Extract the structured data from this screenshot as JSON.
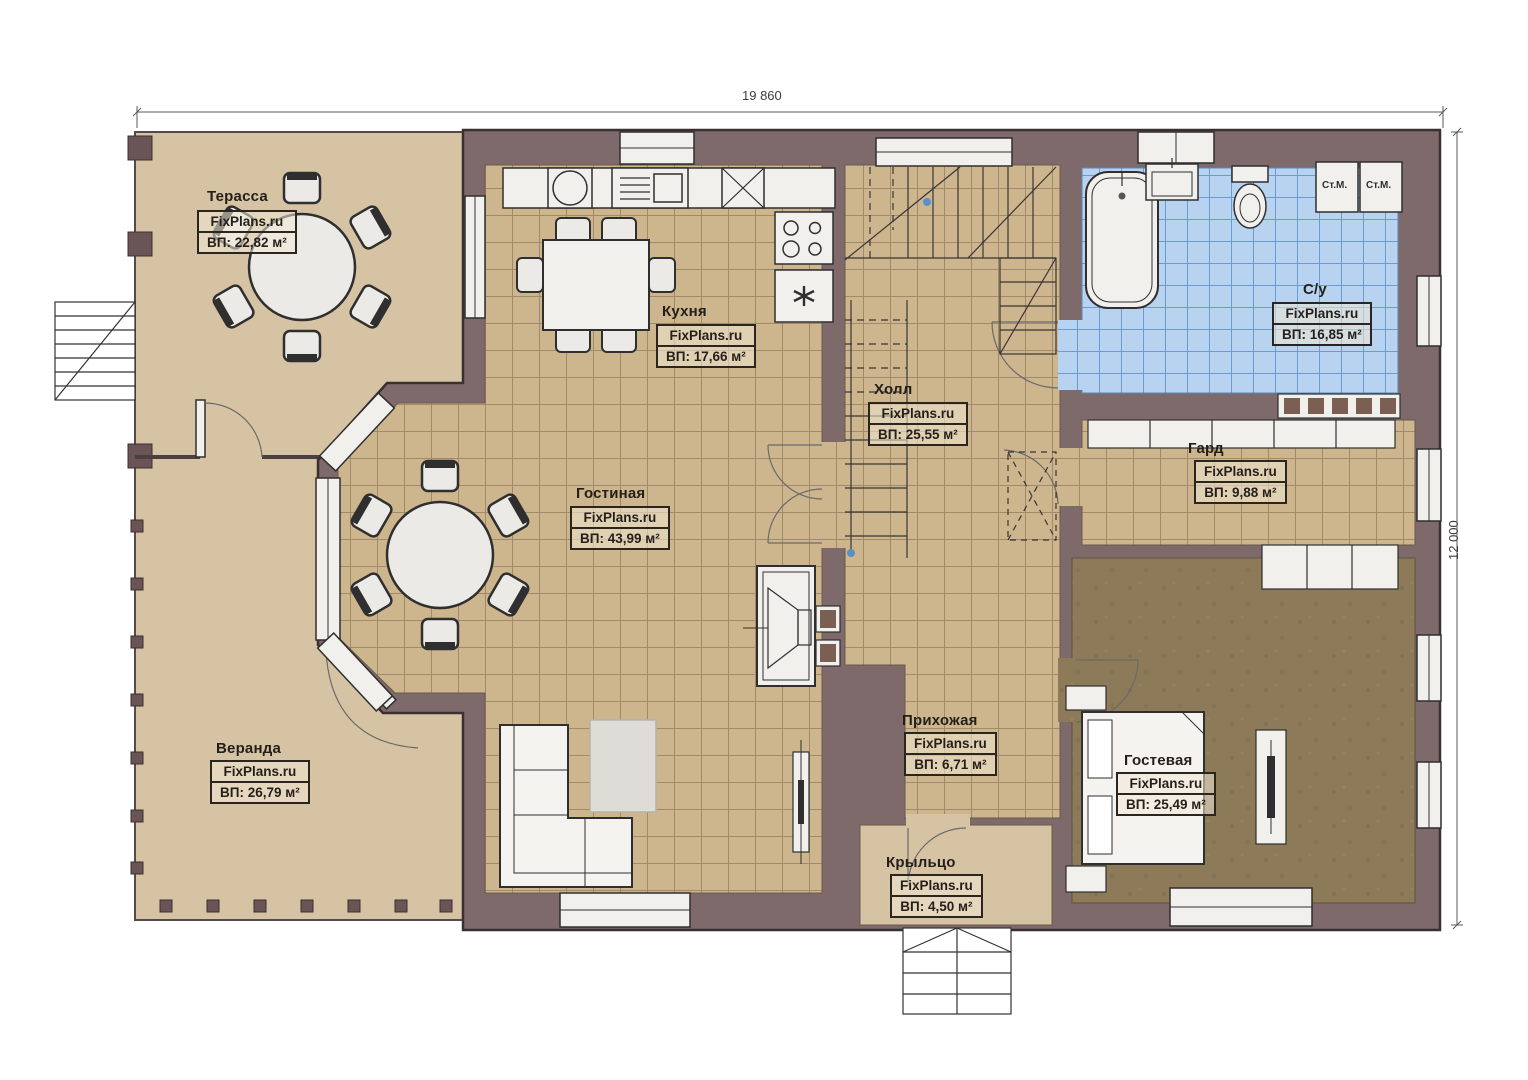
{
  "watermark": "FixPlans.ru",
  "dimensions": {
    "width_label": "19 860",
    "height_label": "12 000"
  },
  "rooms": {
    "terrace": {
      "name": "Терасса",
      "area": "ВП: 22,82 м²"
    },
    "kitchen": {
      "name": "Кухня",
      "area": "ВП: 17,66 м²"
    },
    "hall": {
      "name": "Холл",
      "area": "ВП: 25,55 м²"
    },
    "bathroom": {
      "name": "С/у",
      "area": "ВП: 16,85 м²"
    },
    "wardrobe": {
      "name": "Гард",
      "area": "ВП: 9,88 м²"
    },
    "living": {
      "name": "Гостиная",
      "area": "ВП: 43,99 м²"
    },
    "veranda": {
      "name": "Веранда",
      "area": "ВП: 26,79 м²"
    },
    "entry": {
      "name": "Прихожая",
      "area": "ВП: 6,71 м²"
    },
    "guest": {
      "name": "Гостевая",
      "area": "ВП: 25,49 м²"
    },
    "porch": {
      "name": "Крыльцо",
      "area": "ВП: 4,50 м²"
    }
  },
  "appliances": {
    "washer1": "Ст.М.",
    "washer2": "Ст.М."
  },
  "colors": {
    "wall": "#7e696b",
    "wall_outline": "#453a3c",
    "tile_floor": "#cdb68d",
    "tile_grid": "#a2896a",
    "bath_floor": "#b7d3ef",
    "bath_grid": "#6d9bd0",
    "deck_floor": "#d5c3a3",
    "guest_floor": "#8c7a59",
    "fixture": "#f1f0ec",
    "line": "#2f2f2f"
  }
}
